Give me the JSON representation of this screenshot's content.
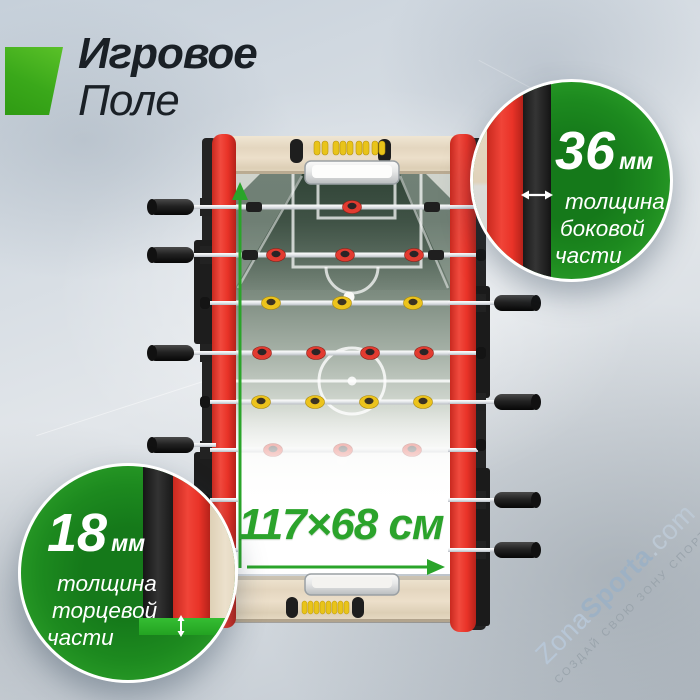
{
  "title": {
    "line1": "Игровое",
    "line2": "Поле"
  },
  "dimension": {
    "label": "117×68 см"
  },
  "callouts": {
    "side": {
      "value": "36",
      "unit": "мм",
      "lines": [
        "толщина",
        "боковой",
        "части"
      ]
    },
    "end": {
      "value": "18",
      "unit": "мм",
      "lines": [
        "толщина",
        "торцевой",
        "части"
      ]
    }
  },
  "watermark": {
    "zona": "Zona",
    "sporta": "Sporta",
    "tld": ".com",
    "slogan": "СОЗДАЙ СВОЮ ЗОНУ СПОРТА"
  },
  "colors": {
    "accent_green": "#2ba32b",
    "callout_green": "#1d8a1f",
    "rail_red": "#e93328",
    "field_green": "#5c6e62",
    "wood": "#e9dec9",
    "bead_yellow": "#e9c419",
    "title_dark": "#1a2026"
  }
}
